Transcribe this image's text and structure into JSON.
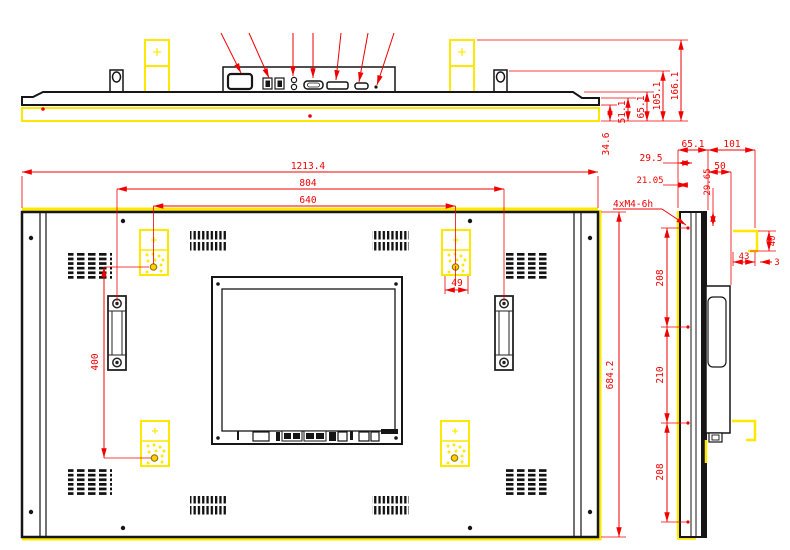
{
  "colors": {
    "line": "#161616",
    "dimension": "#f10000",
    "highlight": "#ffe800"
  },
  "top_view": {
    "dims": {
      "h166": "166.1",
      "h105": "105.1",
      "h65": "65.1",
      "h51": "51.1",
      "h34": "34.6"
    }
  },
  "rear_view": {
    "dims": {
      "width": "1213.4",
      "handle_span": "804",
      "mount_w": "640",
      "height": "684.2",
      "mount_h": "400",
      "offset": "49"
    }
  },
  "side_view": {
    "callout": "4xM4-6h",
    "dims": {
      "d65": "65.1",
      "d101": "101",
      "d29_5": "29.5",
      "d50": "50",
      "d21": "21.05",
      "d29_65": "29.65",
      "s208a": "208",
      "s210": "210",
      "s208b": "208",
      "d40": "40",
      "d43": "43",
      "d3": "3"
    }
  }
}
